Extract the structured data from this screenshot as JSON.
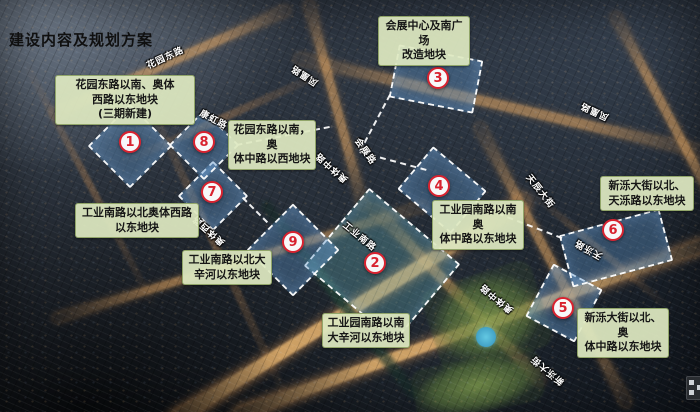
{
  "title": "建设内容及规划方案",
  "map": {
    "zones": [
      {
        "number": "1",
        "label": "花园东路以南、奥体\n西路以东地块\n(三期新建)",
        "circle": {
          "x": 130,
          "y": 142
        },
        "box": {
          "x": 55,
          "y": 75,
          "w": 140
        },
        "outline": {
          "x": 130,
          "y": 146,
          "w": 56,
          "h": 56,
          "r": 45
        }
      },
      {
        "number": "2",
        "label": "工业园南路以南\n大辛河以东地块",
        "circle": {
          "x": 375,
          "y": 263
        },
        "box": {
          "x": 322,
          "y": 313,
          "w": 88
        },
        "outline": {
          "x": 382,
          "y": 265,
          "w": 115,
          "h": 98,
          "r": 40
        },
        "tint": "rgba(98,168,176,0.34)"
      },
      {
        "number": "3",
        "label": "会展中心及南广场\n改造地块",
        "circle": {
          "x": 438,
          "y": 78
        },
        "box": {
          "x": 378,
          "y": 16,
          "w": 92
        },
        "outline": {
          "x": 436,
          "y": 79,
          "w": 82,
          "h": 50,
          "r": 11
        }
      },
      {
        "number": "4",
        "label": "工业园南路以南奥\n体中路以东地块",
        "circle": {
          "x": 439,
          "y": 186
        },
        "box": {
          "x": 432,
          "y": 200,
          "w": 92
        },
        "outline": {
          "x": 442,
          "y": 190,
          "w": 66,
          "h": 52,
          "r": 40
        }
      },
      {
        "number": "5",
        "label": "新泺大街以北、奥\n体中路以东地块",
        "circle": {
          "x": 563,
          "y": 308
        },
        "box": {
          "x": 577,
          "y": 308,
          "w": 92
        },
        "outline": {
          "x": 564,
          "y": 303,
          "w": 52,
          "h": 56,
          "r": 28
        }
      },
      {
        "number": "6",
        "label": "新泺大街以北、\n天泺路以东地块",
        "circle": {
          "x": 613,
          "y": 230
        },
        "box": {
          "x": 600,
          "y": 176,
          "w": 94
        },
        "outline": {
          "x": 616,
          "y": 248,
          "w": 100,
          "h": 50,
          "r": -15
        }
      },
      {
        "number": "7",
        "label": "工业南路以北奥体西路\n以东地块",
        "circle": {
          "x": 212,
          "y": 192
        },
        "box": {
          "x": 75,
          "y": 203,
          "w": 124
        },
        "outline": {
          "x": 213,
          "y": 196,
          "w": 46,
          "h": 46,
          "r": 45
        }
      },
      {
        "number": "8",
        "label": "花园东路以南，奥\n体中路以西地块",
        "circle": {
          "x": 204,
          "y": 142
        },
        "box": {
          "x": 228,
          "y": 120,
          "w": 88
        },
        "outline": {
          "x": 204,
          "y": 145,
          "w": 46,
          "h": 46,
          "r": 45
        }
      },
      {
        "number": "9",
        "label": "工业南路以北大\n辛河以东地块",
        "circle": {
          "x": 293,
          "y": 242
        },
        "box": {
          "x": 182,
          "y": 250,
          "w": 90
        },
        "outline": {
          "x": 293,
          "y": 250,
          "w": 62,
          "h": 62,
          "r": 45
        }
      }
    ],
    "road_labels": [
      {
        "name": "花园东路",
        "x": 165,
        "y": 57,
        "rot": -25
      },
      {
        "name": "康虹路",
        "x": 214,
        "y": 119,
        "rot": 28
      },
      {
        "name": "凤凰路",
        "x": 304,
        "y": 76,
        "rot": 213
      },
      {
        "name": "会展路",
        "x": 366,
        "y": 151,
        "rot": 55
      },
      {
        "name": "奥体中路",
        "x": 331,
        "y": 168,
        "rot": 222
      },
      {
        "name": "奥体西路",
        "x": 208,
        "y": 231,
        "rot": 222
      },
      {
        "name": "工业南路",
        "x": 360,
        "y": 236,
        "rot": 39
      },
      {
        "name": "天辰大街",
        "x": 541,
        "y": 191,
        "rot": 52
      },
      {
        "name": "凤凰路",
        "x": 594,
        "y": 112,
        "rot": 205
      },
      {
        "name": "天泺路",
        "x": 588,
        "y": 250,
        "rot": 210
      },
      {
        "name": "奥体中路",
        "x": 496,
        "y": 299,
        "rot": 220
      },
      {
        "name": "新泺大街",
        "x": 547,
        "y": 371,
        "rot": 220
      }
    ],
    "road_stripes": [
      {
        "x": 170,
        "y": 62,
        "len": 260,
        "th": 9,
        "r": -24,
        "v": "med"
      },
      {
        "x": 225,
        "y": 117,
        "len": 230,
        "th": 8,
        "r": -24,
        "v": "dim"
      },
      {
        "x": 500,
        "y": 105,
        "len": 420,
        "th": 10,
        "r": 13,
        "v": "med"
      },
      {
        "x": 215,
        "y": 245,
        "len": 360,
        "th": 8,
        "r": 65,
        "v": "dim"
      },
      {
        "x": 90,
        "y": 185,
        "len": 280,
        "th": 7,
        "r": 62,
        "v": "dim"
      },
      {
        "x": 336,
        "y": 105,
        "len": 215,
        "th": 9,
        "r": 75,
        "v": "med"
      },
      {
        "x": 458,
        "y": 295,
        "len": 245,
        "th": 10,
        "r": 46,
        "v": "med"
      },
      {
        "x": 240,
        "y": 262,
        "len": 390,
        "th": 8,
        "r": -17,
        "v": "med"
      },
      {
        "x": 350,
        "y": 310,
        "len": 420,
        "th": 13,
        "r": -32,
        "v": "bright"
      },
      {
        "x": 470,
        "y": 330,
        "len": 500,
        "th": 11,
        "r": -20,
        "v": "bright"
      },
      {
        "x": 553,
        "y": 265,
        "len": 320,
        "th": 9,
        "r": 62,
        "v": "med"
      },
      {
        "x": 600,
        "y": 250,
        "len": 180,
        "th": 7,
        "r": 40,
        "v": "dim"
      },
      {
        "x": 668,
        "y": 115,
        "len": 230,
        "th": 9,
        "r": 62,
        "v": "med"
      }
    ],
    "river": {
      "x": 340,
      "y": 300,
      "len": 250,
      "th": 11,
      "r": 52
    },
    "parks": [
      {
        "x": 487,
        "y": 318,
        "w": 115,
        "h": 90,
        "r": -18
      },
      {
        "x": 478,
        "y": 385,
        "w": 130,
        "h": 55,
        "r": -12
      }
    ],
    "pond": {
      "x": 486,
      "y": 337,
      "d": 20
    },
    "segments": [
      {
        "x": 375,
        "y": 123,
        "len": 64,
        "r": 118
      },
      {
        "x": 393,
        "y": 161,
        "len": 69,
        "r": 15
      },
      {
        "x": 283,
        "y": 136,
        "len": 95,
        "r": -11
      },
      {
        "x": 255,
        "y": 210,
        "len": 35,
        "r": 45
      },
      {
        "x": 520,
        "y": 222,
        "len": 90,
        "r": 21
      }
    ],
    "accent_red": "#d8222f",
    "label_bg": "#dee8c1",
    "dash_color": "#ffffff"
  }
}
